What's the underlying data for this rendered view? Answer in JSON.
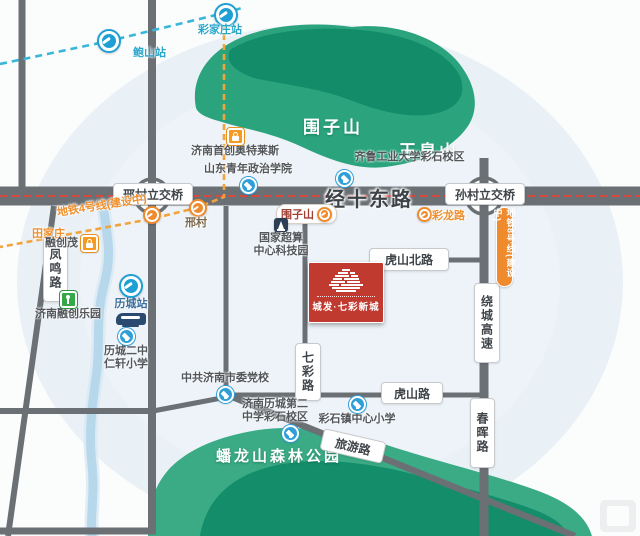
{
  "regions": {
    "weizishan_mountain": "围子山",
    "yuhuangshan_mountain": "玉皇山",
    "panlongshan_park": "蟠龙山森林公园"
  },
  "roads": {
    "jingshidong": "经十东路",
    "xingcun_interchange": "邢村立交桥",
    "suncun_interchange": "孙村立交桥",
    "fengming": "凤鸣路",
    "qicai": "七彩路",
    "hushanbei": "虎山北路",
    "hushan": "虎山路",
    "raocheng_expressway": "绕城高速",
    "chunhui": "春晖路",
    "lvyou": "旅游路"
  },
  "metro": {
    "line4_label": "地铁4号线(建设中)",
    "line8_label": "地铁8号线(建设中)",
    "stations": {
      "baoshan": "鲍山站",
      "caijiazhuang": "彩家庄站",
      "tianjiazhuang": "田家庄",
      "xingcun": "邢村",
      "weizishan": "围子山",
      "cailonglu": "彩龙路"
    }
  },
  "pois": [
    {
      "id": "shouchuang_outlets",
      "type": "mall",
      "lines": [
        "济南首创奥特莱斯"
      ]
    },
    {
      "id": "qilu_tech_university_caishi",
      "type": "school",
      "lines": [
        "齐鲁工业大学彩石校区"
      ]
    },
    {
      "id": "shandong_youth_college",
      "type": "school",
      "lines": [
        "山东青年政治学院"
      ]
    },
    {
      "id": "national_supercomputing_park",
      "type": "tech",
      "lines": [
        "国家超算",
        "中心科技园"
      ]
    },
    {
      "id": "rongchuang_mall",
      "type": "mall",
      "lines": [
        "融创茂"
      ]
    },
    {
      "id": "jinan_rongchuang_park",
      "type": "park",
      "lines": [
        "济南融创乐园"
      ]
    },
    {
      "id": "licheng_station",
      "type": "rail",
      "lines": [
        "历城站"
      ]
    },
    {
      "id": "licheng_erzhong_renxuan_primary",
      "type": "school",
      "lines": [
        "历城二中",
        "仁轩小学"
      ]
    },
    {
      "id": "jinan_party_school",
      "type": "school",
      "lines": [
        "中共济南市委党校"
      ]
    },
    {
      "id": "licheng_no2_middle_caishi_campus",
      "type": "school",
      "lines": [
        "济南历城第二",
        "中学彩石校区"
      ]
    },
    {
      "id": "caishi_town_central_primary",
      "type": "school",
      "lines": [
        "彩石镇中心小学"
      ]
    }
  ],
  "project": {
    "name": "城发·七彩新城"
  },
  "colors": {
    "road": "#6b7075",
    "mountain_green": "#2ba47d",
    "mountain_dark_green": "#128c69",
    "metro_line_cyan": "#38b7d8",
    "metro_line_orange": "#f2a33c",
    "road_centerline_red": "#e2453a",
    "project_red": "#c13a30",
    "river_blue": "#b7d7eb"
  }
}
